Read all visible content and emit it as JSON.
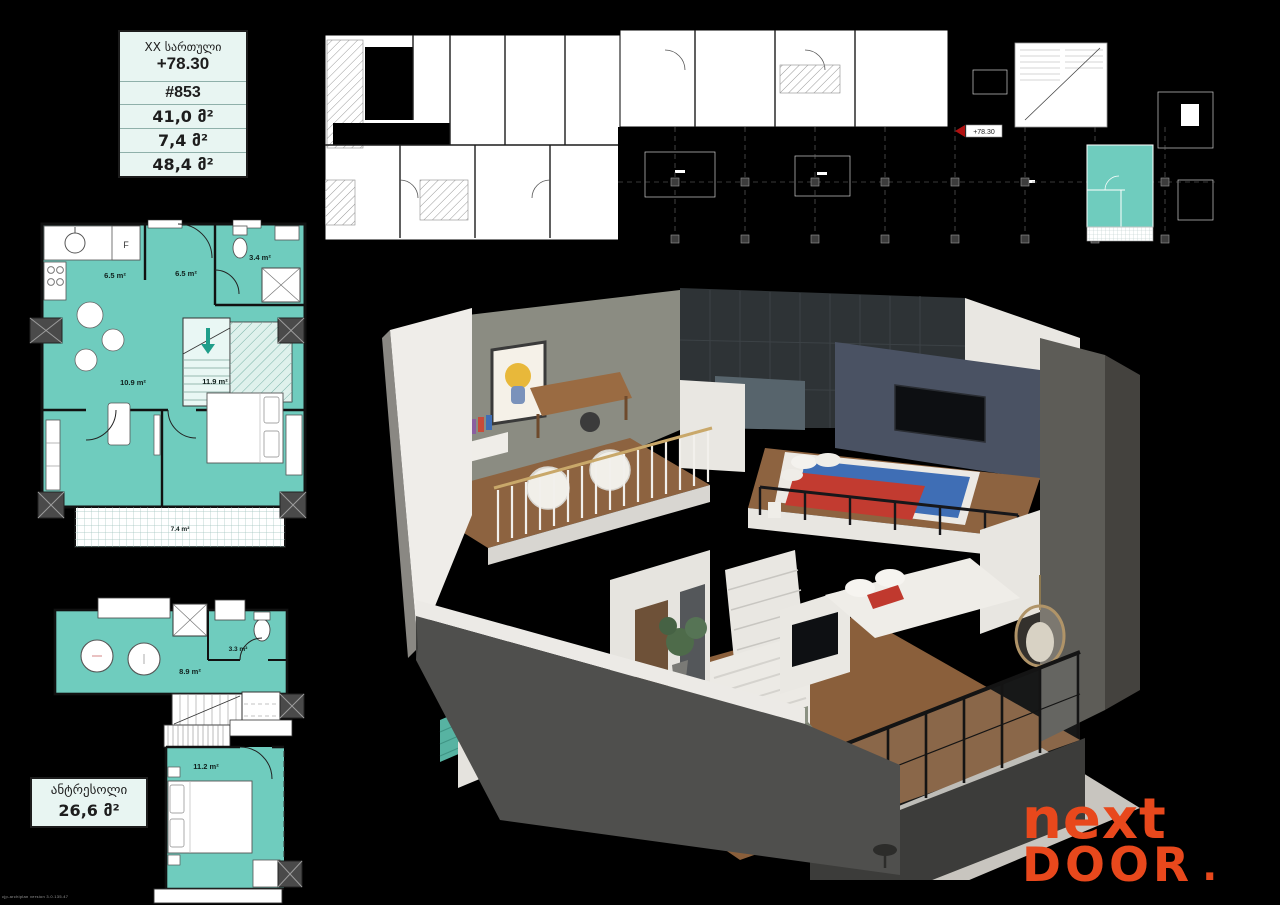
{
  "page": {
    "background": "#000000"
  },
  "info_table": {
    "floor_label": "XX სართული",
    "elevation": "+78.30",
    "unit_number": "#853",
    "area_apartment": "41,0 მ²",
    "area_balcony": "7,4 მ²",
    "area_total": "48,4 მ²"
  },
  "building_plan": {
    "elevation_marker": "+78.30"
  },
  "level1_plan": {
    "kitchen_area": "6.5 m²",
    "hall_area": "6.5 m²",
    "bathroom_area": "3.4 m²",
    "living_area": "10.9 m²",
    "bedroom_area": "11.9 m²",
    "balcony_area": "7.4 m²",
    "fridge_label": "F"
  },
  "mezzanine_plan": {
    "hall_area": "8.9 m²",
    "bathroom_area": "3.3 m²"
  },
  "mezzanine_bedroom_plan": {
    "bedroom_area": "11.2 m²"
  },
  "mezzanine_box": {
    "title": "ანტრესოლი",
    "area": "26,6 მ²"
  },
  "logo": {
    "line1": "next",
    "line2": "DOOR",
    "dot": "."
  },
  "watermark": "cjp-archiplan version 3.0.135.47",
  "colors": {
    "plan_teal": "#6fccbe",
    "plan_teal_light": "#dff1ec",
    "mint_panel": "#e8f5f2",
    "logo_orange": "#e8481c"
  }
}
